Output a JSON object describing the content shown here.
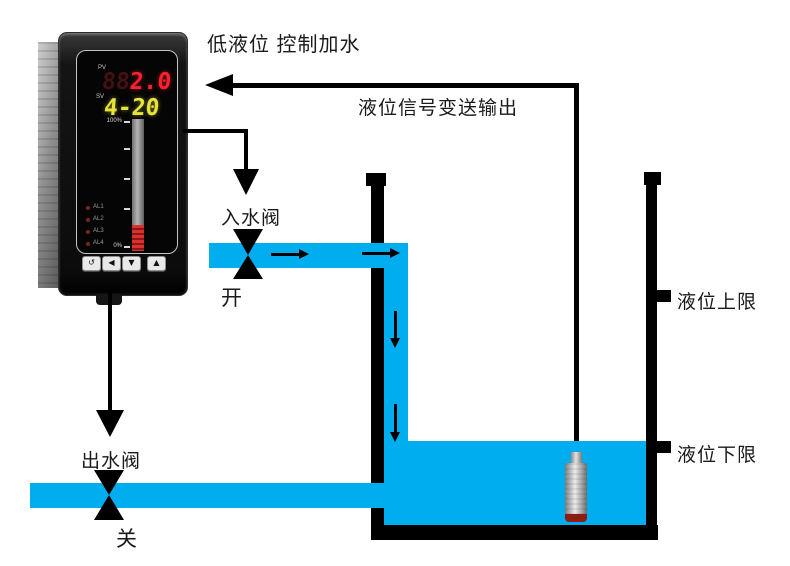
{
  "title": "低液位 控制加水",
  "signal": {
    "label": "液位信号变送输出"
  },
  "inlet": {
    "label": "入水阀",
    "state": "开"
  },
  "outlet": {
    "label": "出水阀",
    "state": "关"
  },
  "tank": {
    "upper_limit": "液位上限",
    "lower_limit": "液位下限"
  },
  "meter": {
    "pv_label": "PV",
    "pv_ghost": "88",
    "pv_value": "2.0",
    "sv_label": "SV",
    "sv_value": "4-20",
    "bar_top": "100%",
    "bar_bottom": "0%",
    "alarms": [
      "AL1",
      "AL2",
      "AL3",
      "AL4"
    ],
    "buttons": [
      "↺",
      "◀",
      "▼",
      "▲"
    ]
  },
  "colors": {
    "water": "#00aeef",
    "pv_red": "#ff1f2e",
    "sv_yellow": "#e6e33a"
  }
}
